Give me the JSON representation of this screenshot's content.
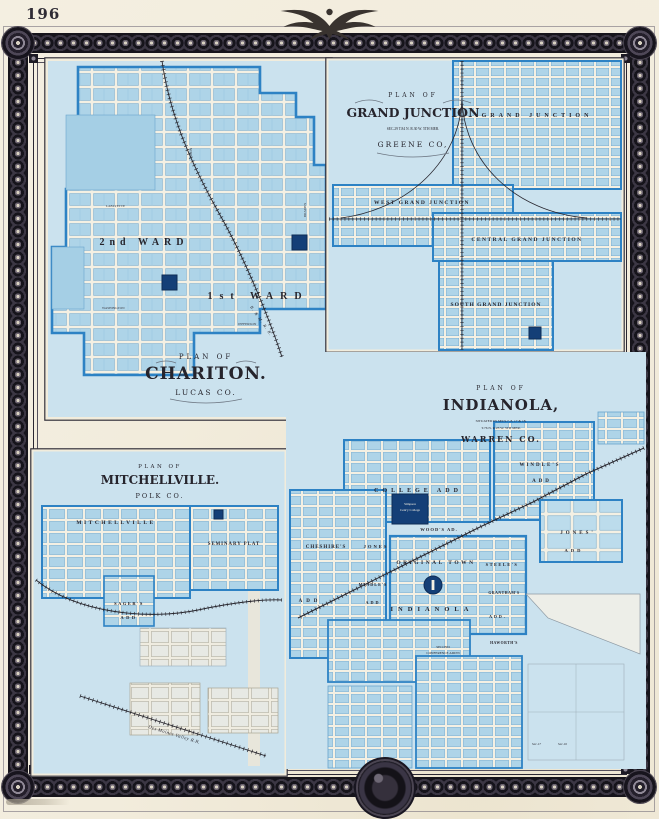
{
  "page": {
    "number": "196"
  },
  "colors": {
    "paper": "#f2ecdc",
    "frame_ink": "#1e1b24",
    "map_wash": "#cbe2ee",
    "block_blue": "#aed4e8",
    "boundary_blue": "#2d82c4",
    "public_square_navy": "#143f77",
    "ink": "#26242c"
  },
  "chariton": {
    "plan_of": "PLAN OF",
    "name": "CHARITON.",
    "county": "LUCAS CO.",
    "ward2": "2nd WARD",
    "ward1": "1st WARD",
    "railroad": "B. & M. R. R.",
    "streets": [
      "MAIN",
      "LAFAYETTE",
      "WASHINGTON",
      "JEFFERSON",
      "BRADEN"
    ]
  },
  "grand_junction": {
    "plan_of": "PLAN OF",
    "name": "GRAND JUNCTION",
    "legal": "SEC.29 T.84 N. R.30 W. 5TH MER.",
    "county": "GREENE CO,",
    "areas": {
      "north": "GRAND JUNCTION",
      "west": "WEST GRAND JUNCTION",
      "central": "CENTRAL GRAND JUNCTION",
      "south": "SOUTH GRAND JUNCTION"
    }
  },
  "mitchellville": {
    "plan_of": "PLAN OF",
    "name": "MITCHELLVILLE.",
    "county": "POLK CO.",
    "town": "MITCHELLVILLE",
    "seminary": "SEMINARY PLAT",
    "sagers": "SAGER'S",
    "sagers_add": "ADD",
    "railroad": "Des Moines Valley R.R."
  },
  "indianola": {
    "plan_of": "PLAN OF",
    "name": "INDIANOLA,",
    "legal1": "SITUATED IN SECS.7, 8, 17 & 18,",
    "legal2": "T.76 N. R.23 W. 5TH MER.",
    "county": "WARREN CO.",
    "college_add": "COLLEGE ADD",
    "windles": "WINDLE'S",
    "windles_add": "ADD",
    "woods": "WOOD'S AD.",
    "cheshires": "CHESHIRE'S",
    "cheshires_add": "ADD",
    "jones": "JONES",
    "mindles": "MINDLE'S",
    "mindles_add": "ADD",
    "original": "ORIGINAL TOWN",
    "town": "INDIANOLA",
    "steeles": "STEELE'S",
    "granthams": "GRANTHAM'S",
    "granthams_add": "ADD.",
    "haworths": "HAWORTH'S",
    "conference1": "SECOND",
    "conference2": "CONFERENCE ADD'N",
    "jones_e": "JONES'",
    "jones_e_add": "ADD",
    "college_l1": "Simpson",
    "college_l2": "Cent'y College",
    "sec_a": "Sec.17",
    "sec_b": "Sec.16"
  }
}
